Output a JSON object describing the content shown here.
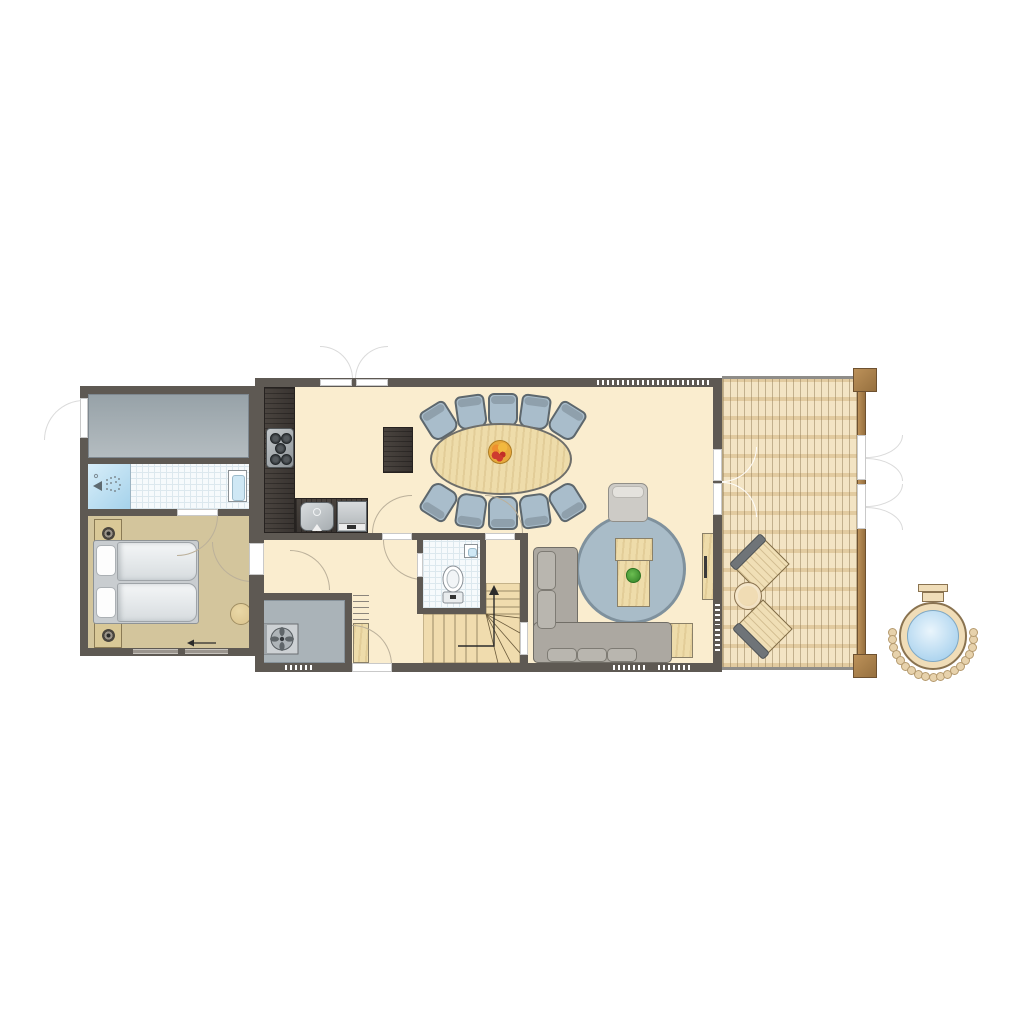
{
  "image": {
    "width": 1024,
    "height": 1024,
    "background": "#FFFFFF",
    "description": "Architectural floor plan of a holiday lodge with bedroom annex, open kitchen-dining-living area, wooden deck and outdoor hot tub. No text labels are rendered in the drawing."
  },
  "palette": {
    "wall": "#5E5953",
    "floor_cream": "#FAEDCF",
    "floor_tan": "#D3C59C",
    "floor_gray_light": "#B4BCC0",
    "floor_gray_dark": "#97A2A8",
    "tile": "#F6FAFC",
    "tile_line": "#DCE8EE",
    "shower_blue_1": "#D8EEF9",
    "shower_blue_2": "#A5D2EB",
    "table_wood": "#EEDCAA",
    "chair_fill": "#A9BDCB",
    "chair_back": "#8FA0AC",
    "chair_border": "#5D676D",
    "rug": "#A9BCC8",
    "rug_border": "#7F919D",
    "sofa": "#ACA8A1",
    "sofa_border": "#716E67",
    "sofa_cushion": "#B9B6AF",
    "armchair": "#CDCBC6",
    "stair_wood": "#F0DCAE",
    "stair_line": "#9A8A67",
    "deck_base": "#F3E4C4",
    "deck_joist": "#E2CBA0",
    "deck_frame": "#8F8D89",
    "tub_rim": "#F0DDB8",
    "tub_border": "#8A7350",
    "water_1": "#EAF5FC",
    "water_2": "#A9D2EE",
    "stone": "#E7D2AC",
    "arc_line": "#BBB09A"
  },
  "plan": {
    "buildings": [
      {
        "id": "left-annex",
        "rooms": [
          {
            "id": "storage-room",
            "floor": "concrete-gray",
            "doors": [
              "exterior-door-left"
            ]
          },
          {
            "id": "bathroom",
            "fixtures": [
              "shower",
              "washbasin"
            ],
            "floor": "white-tile"
          },
          {
            "id": "bedroom",
            "floor": "tan",
            "furniture": [
              "bed-two-singles",
              "nightstand",
              "nightstand",
              "round-pouf"
            ],
            "markers": [
              "entrance-arrow-pointing-left"
            ],
            "windows": 2
          }
        ]
      },
      {
        "id": "main-building",
        "rooms": [
          {
            "id": "kitchen-dining",
            "floor": "cream",
            "furniture": [
              "l-shaped-kitchen-counter",
              "stove-5-burners",
              "kitchen-sink",
              "dishwasher",
              "dark-sideboard",
              "oval-dining-table",
              "fruit-bowl"
            ],
            "dining_chair_count": 10,
            "doors": [
              "french-doors-top"
            ],
            "windows": [
              "top-wall-window"
            ]
          },
          {
            "id": "hallway",
            "floor": "cream",
            "doors": [
              "door-to-bedroom-annex",
              "door-to-dining",
              "door-to-toilet",
              "back-door"
            ]
          },
          {
            "id": "toilet-room",
            "floor": "white-tile",
            "fixtures": [
              "toilet",
              "hand-basin"
            ]
          },
          {
            "id": "staircase",
            "type": "winder",
            "markers": [
              "up-arrow"
            ]
          },
          {
            "id": "utility-room",
            "floor": "gray",
            "fixtures": [
              "ventilation-unit",
              "shelving",
              "closet"
            ],
            "windows": 1
          },
          {
            "id": "living-room",
            "floor": "cream",
            "furniture": [
              "corner-sofa",
              "round-rug",
              "coffee-table",
              "potted-plant",
              "armchair",
              "side-table",
              "tv-cabinet"
            ],
            "doors": [
              "double-door-to-deck"
            ],
            "windows": 2
          }
        ]
      },
      {
        "id": "deck",
        "floor": "wood-planks",
        "furniture": [
          "lounge-chair",
          "round-side-table",
          "lounge-chair"
        ],
        "structure": [
          "corner-post-top",
          "corner-post-bottom",
          "rail-with-two-gates"
        ]
      }
    ],
    "outdoor": {
      "id": "hot-tub",
      "features": [
        "entry-steps",
        "round-water-basin",
        "stone-ring"
      ],
      "stone_count": 19
    },
    "counts": {
      "dining_chairs": 10,
      "beds": 2,
      "lounge_chairs": 2,
      "stove_burners": 5
    }
  }
}
